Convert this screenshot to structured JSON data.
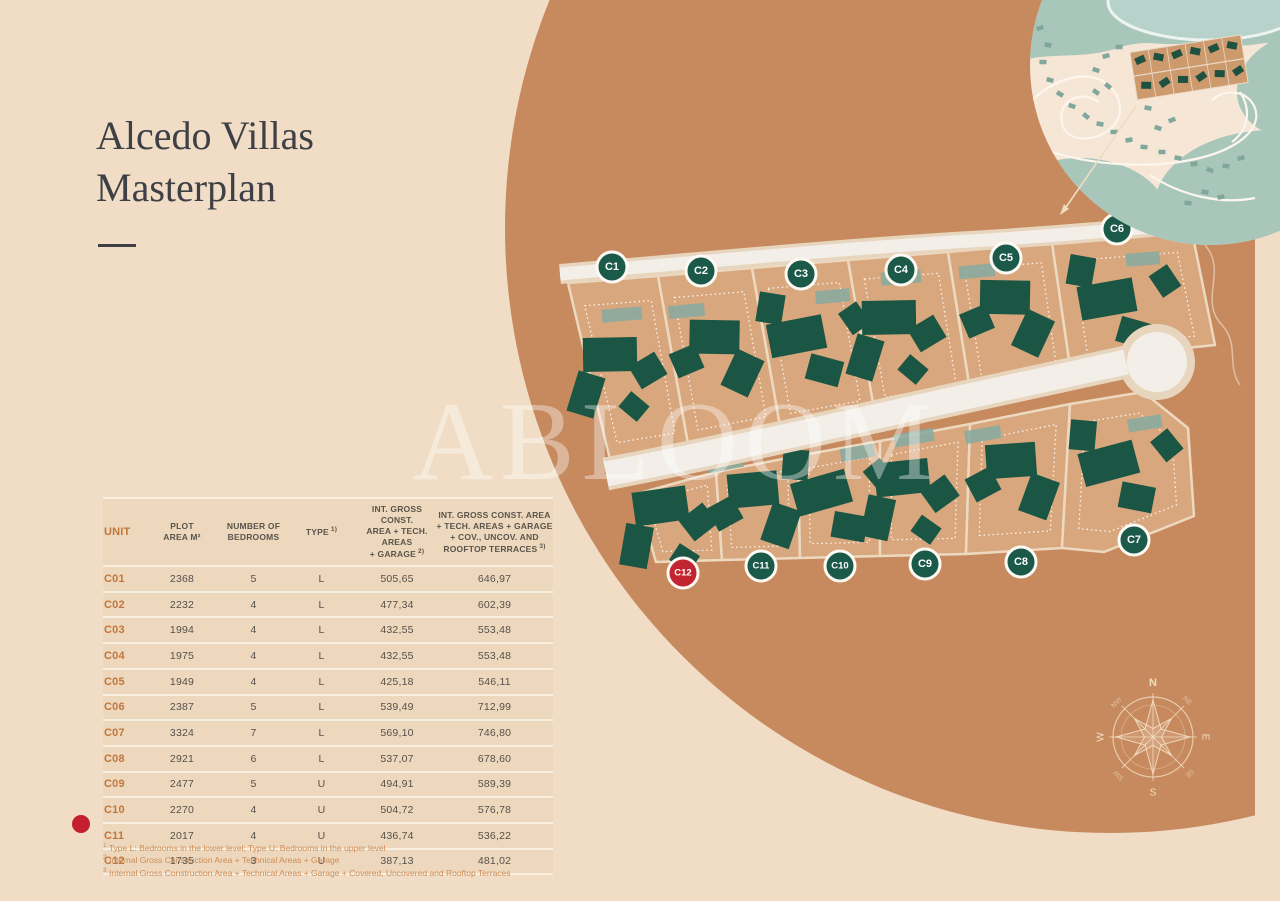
{
  "title": {
    "line1": "Alcedo Villas",
    "line2": "Masterplan"
  },
  "watermark": "ABLOOM",
  "table": {
    "columns": [
      {
        "lines": [
          "UNIT"
        ],
        "sup": "",
        "style": "unit"
      },
      {
        "lines": [
          "PLOT",
          "AREA M²"
        ],
        "sup": ""
      },
      {
        "lines": [
          "NUMBER OF",
          "BEDROOMS"
        ],
        "sup": ""
      },
      {
        "lines": [
          "TYPE"
        ],
        "sup": "1)"
      },
      {
        "lines": [
          "INT. GROSS CONST.",
          "AREA + TECH. AREAS",
          "+ GARAGE"
        ],
        "sup": "2)"
      },
      {
        "lines": [
          "INT. GROSS CONST. AREA",
          "+ TECH. AREAS + GARAGE",
          "+ COV., UNCOV. AND",
          "ROOFTOP TERRACES"
        ],
        "sup": "3)"
      }
    ],
    "rows": [
      {
        "unit": "C01",
        "plot": "2368",
        "bedrooms": "5",
        "type": "L",
        "area1": "505,65",
        "area2": "646,97",
        "highlighted": false
      },
      {
        "unit": "C02",
        "plot": "2232",
        "bedrooms": "4",
        "type": "L",
        "area1": "477,34",
        "area2": "602,39",
        "highlighted": false
      },
      {
        "unit": "C03",
        "plot": "1994",
        "bedrooms": "4",
        "type": "L",
        "area1": "432,55",
        "area2": "553,48",
        "highlighted": false
      },
      {
        "unit": "C04",
        "plot": "1975",
        "bedrooms": "4",
        "type": "L",
        "area1": "432,55",
        "area2": "553,48",
        "highlighted": false
      },
      {
        "unit": "C05",
        "plot": "1949",
        "bedrooms": "4",
        "type": "L",
        "area1": "425,18",
        "area2": "546,11",
        "highlighted": false
      },
      {
        "unit": "C06",
        "plot": "2387",
        "bedrooms": "5",
        "type": "L",
        "area1": "539,49",
        "area2": "712,99",
        "highlighted": false
      },
      {
        "unit": "C07",
        "plot": "3324",
        "bedrooms": "7",
        "type": "L",
        "area1": "569,10",
        "area2": "746,80",
        "highlighted": false
      },
      {
        "unit": "C08",
        "plot": "2921",
        "bedrooms": "6",
        "type": "L",
        "area1": "537,07",
        "area2": "678,60",
        "highlighted": false
      },
      {
        "unit": "C09",
        "plot": "2477",
        "bedrooms": "5",
        "type": "U",
        "area1": "494,91",
        "area2": "589,39",
        "highlighted": false
      },
      {
        "unit": "C10",
        "plot": "2270",
        "bedrooms": "4",
        "type": "U",
        "area1": "504,72",
        "area2": "576,78",
        "highlighted": false
      },
      {
        "unit": "C11",
        "plot": "2017",
        "bedrooms": "4",
        "type": "U",
        "area1": "436,74",
        "area2": "536,22",
        "highlighted": false
      },
      {
        "unit": "C12",
        "plot": "1735",
        "bedrooms": "3",
        "type": "U",
        "area1": "387,13",
        "area2": "481,02",
        "highlighted": true
      }
    ],
    "footnotes": [
      {
        "sup": "1",
        "text": "Type L: Bedrooms in the lower level; Type U: Bedrooms in the upper level"
      },
      {
        "sup": "2",
        "text": "Internal Gross Construction Area + Technical Areas + Garage"
      },
      {
        "sup": "3",
        "text": "Internal Gross Construction Area + Technical Areas + Garage + Covered, Uncovered and Rooftop Terraces"
      }
    ]
  },
  "map": {
    "badges": [
      {
        "label": "C1",
        "color": "green"
      },
      {
        "label": "C2",
        "color": "green"
      },
      {
        "label": "C3",
        "color": "green"
      },
      {
        "label": "C4",
        "color": "green"
      },
      {
        "label": "C5",
        "color": "green"
      },
      {
        "label": "C6",
        "color": "green"
      },
      {
        "label": "C7",
        "color": "green"
      },
      {
        "label": "C8",
        "color": "green"
      },
      {
        "label": "C9",
        "color": "green"
      },
      {
        "label": "C10",
        "color": "green"
      },
      {
        "label": "C11",
        "color": "green"
      },
      {
        "label": "C12",
        "color": "red"
      }
    ],
    "compass": {
      "n": "N",
      "ne": "NE",
      "e": "E",
      "se": "SE",
      "s": "S",
      "sw": "SW",
      "w": "W",
      "nw": "NW"
    },
    "colors": {
      "page_bg": "#f1ddc6",
      "circle": "#c78a5e",
      "plot": "#d8a77d",
      "plot_stroke": "#ecd9c0",
      "building": "#1b5543",
      "pool": "#8aab9f",
      "road": "#f3efe8",
      "road_casing": "#e7d5be",
      "badge_green": "#1b5948",
      "badge_red": "#c22531",
      "inset_land": "#f6e6d6",
      "inset_green": "#a9c6ba",
      "inset_lake": "#b7d2cb",
      "inset_building": "#7fa79c",
      "inset_parcel": "#cd9a6e",
      "unit_accent": "#c0763c",
      "footnote": "#cd8b55",
      "title_ink": "#3e4046"
    }
  }
}
